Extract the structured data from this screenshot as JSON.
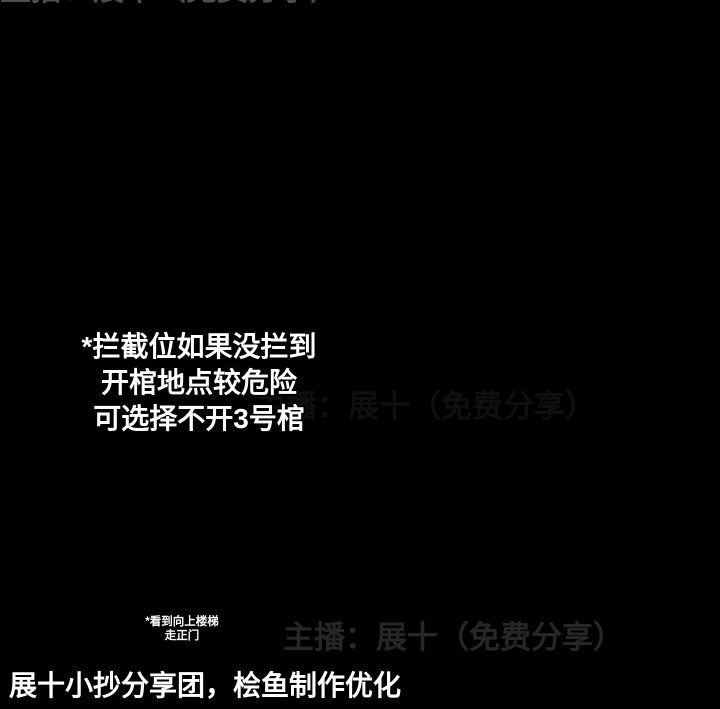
{
  "title": {
    "line1": "双队打架图",
    "line2": "3号位"
  },
  "note": [
    "*拦截位如果没拦到",
    "开棺地点较危险",
    "可选择不开3号棺"
  ],
  "small_note": [
    "*看到向上楼梯",
    "走正门"
  ],
  "watermark_text": "主播：展十（免费分享）",
  "footer": "展十小抄分享团，桧鱼制作优化",
  "icons": {
    "coffin": "chinese-coffin",
    "ladder": "ladder",
    "door_marker": "teal-dash",
    "spawn_marker": "red-diamond"
  },
  "palette": {
    "bg": "#000000",
    "B": "#4d6174",
    "B2": "#42566a",
    "N": "#2e3d4c",
    "R": "#8b5d55",
    "R2": "#74473f",
    "D": "#5d423c",
    "M": "#6b403c",
    "T": "#24424c",
    "magenta": "#f411af",
    "red": "#e60f1b",
    "cyan": "#22dcf2",
    "green": "#27e23c",
    "lime": "#19e839",
    "yellow": "#eeea28",
    "title_cyan": "#8df0f6",
    "white": "#ffffff",
    "watermark": "#9a9a9a"
  },
  "labels": [
    {
      "t": "正1",
      "x": 184,
      "y": 77,
      "fs": 29,
      "c": "white",
      "a": "start",
      "outline": true
    },
    {
      "t": "侧1",
      "x": 377,
      "y": 167,
      "fs": 26,
      "c": "green",
      "a": "start",
      "outline": true
    },
    {
      "t": "侧2",
      "x": 142,
      "y": 611,
      "fs": 29,
      "c": "green",
      "a": "start",
      "outline": true
    },
    {
      "t": "正2",
      "x": 339,
      "y": 610,
      "fs": 29,
      "c": "white",
      "a": "start",
      "outline": true
    },
    {
      "t": "1",
      "x": 544,
      "y": 553,
      "fs": 36,
      "c": "magenta",
      "a": "middle",
      "outline": true
    },
    {
      "t": "2",
      "x": 624,
      "y": 414,
      "fs": 34,
      "c": "cyan",
      "a": "middle",
      "outline": true
    },
    {
      "t": "3",
      "x": 517,
      "y": 503,
      "fs": 32,
      "c": "red",
      "a": "middle",
      "outline": true
    }
  ],
  "watermarks": [
    {
      "x": 48,
      "y": 153,
      "fs": 31,
      "op": 0.5
    },
    {
      "x": 283,
      "y": 648,
      "fs": 31,
      "op": 0.5
    },
    {
      "x": 255,
      "y": 417,
      "fs": 31,
      "op": 0.2
    }
  ],
  "map": {
    "rects": [
      {
        "x": 52,
        "y": 33,
        "w": 48,
        "h": 15,
        "c": "B"
      },
      {
        "x": 64,
        "y": 22,
        "w": 12,
        "h": 13,
        "c": "B"
      },
      {
        "x": 46,
        "y": 46,
        "w": 14,
        "h": 11,
        "c": "B"
      },
      {
        "x": 88,
        "y": 49,
        "w": 26,
        "h": 13,
        "c": "B"
      },
      {
        "x": 106,
        "y": 57,
        "w": 28,
        "h": 13,
        "c": "B"
      },
      {
        "x": 124,
        "y": 63,
        "w": 24,
        "h": 15,
        "c": "B"
      },
      {
        "x": 136,
        "y": 52,
        "w": 46,
        "h": 50,
        "c": "B2"
      },
      {
        "x": 143,
        "y": 60,
        "w": 32,
        "h": 30,
        "c": "N"
      },
      {
        "x": 80,
        "y": 86,
        "w": 58,
        "h": 52,
        "c": "R"
      },
      {
        "x": 137,
        "y": 86,
        "w": 9,
        "h": 52,
        "c": "B"
      },
      {
        "x": 143,
        "y": 83,
        "w": 58,
        "h": 17,
        "c": "B"
      },
      {
        "x": 197,
        "y": 100,
        "w": 18,
        "h": 80,
        "c": "B"
      },
      {
        "x": 148,
        "y": 177,
        "w": 98,
        "h": 16,
        "c": "B"
      },
      {
        "x": 168,
        "y": 162,
        "w": 13,
        "h": 15,
        "c": "B"
      },
      {
        "x": 238,
        "y": 166,
        "w": 13,
        "h": 11,
        "c": "B"
      },
      {
        "x": 163,
        "y": 193,
        "w": 16,
        "h": 48,
        "c": "B"
      },
      {
        "x": 150,
        "y": 239,
        "w": 47,
        "h": 14,
        "c": "B"
      },
      {
        "x": 168,
        "y": 253,
        "w": 15,
        "h": 16,
        "c": "B"
      },
      {
        "x": 213,
        "y": 180,
        "w": 30,
        "h": 12,
        "c": "B"
      },
      {
        "x": 242,
        "y": 168,
        "w": 40,
        "h": 13,
        "c": "B"
      },
      {
        "x": 278,
        "y": 160,
        "w": 60,
        "h": 17,
        "c": "B"
      },
      {
        "x": 337,
        "y": 162,
        "w": 24,
        "h": 31,
        "c": "B"
      },
      {
        "x": 298,
        "y": 129,
        "w": 30,
        "h": 26,
        "c": "B"
      },
      {
        "x": 347,
        "y": 152,
        "w": 24,
        "h": 38,
        "c": "B"
      },
      {
        "x": 358,
        "y": 108,
        "w": 25,
        "h": 26,
        "c": "B"
      },
      {
        "x": 378,
        "y": 112,
        "w": 20,
        "h": 31,
        "c": "M"
      },
      {
        "x": 360,
        "y": 133,
        "w": 19,
        "h": 19,
        "c": "B"
      },
      {
        "x": 282,
        "y": 174,
        "w": 18,
        "h": 16,
        "c": "N"
      },
      {
        "x": 348,
        "y": 181,
        "w": 56,
        "h": 51,
        "c": "R"
      },
      {
        "x": 253,
        "y": 198,
        "w": 62,
        "h": 30,
        "c": "R"
      },
      {
        "x": 292,
        "y": 238,
        "w": 41,
        "h": 42,
        "c": "R"
      },
      {
        "x": 250,
        "y": 277,
        "w": 340,
        "h": 18,
        "c": "B"
      },
      {
        "x": 352,
        "y": 258,
        "w": 14,
        "h": 19,
        "c": "B"
      },
      {
        "x": 340,
        "y": 295,
        "w": 14,
        "h": 13,
        "c": "B"
      },
      {
        "x": 420,
        "y": 295,
        "w": 21,
        "h": 48,
        "c": "B"
      },
      {
        "x": 392,
        "y": 352,
        "w": 26,
        "h": 30,
        "c": "B2"
      },
      {
        "x": 397,
        "y": 357,
        "w": 14,
        "h": 14,
        "c": "N"
      },
      {
        "x": 445,
        "y": 248,
        "w": 30,
        "h": 49,
        "c": "R"
      },
      {
        "x": 497,
        "y": 249,
        "w": 24,
        "h": 46,
        "c": "B"
      },
      {
        "x": 500,
        "y": 295,
        "w": 22,
        "h": 56,
        "c": "B"
      },
      {
        "x": 503,
        "y": 326,
        "w": 26,
        "h": 25,
        "c": "N"
      },
      {
        "x": 460,
        "y": 315,
        "w": 23,
        "h": 22,
        "c": "B2"
      },
      {
        "x": 548,
        "y": 250,
        "w": 14,
        "h": 28,
        "c": "B"
      },
      {
        "x": 548,
        "y": 295,
        "w": 15,
        "h": 15,
        "c": "B"
      },
      {
        "x": 485,
        "y": 208,
        "w": 30,
        "h": 62,
        "c": "R"
      },
      {
        "x": 487,
        "y": 245,
        "w": 20,
        "h": 20,
        "c": "N"
      },
      {
        "x": 686,
        "y": 158,
        "w": 28,
        "h": 21,
        "c": "B"
      },
      {
        "x": 690,
        "y": 179,
        "w": 30,
        "h": 133,
        "c": "R"
      },
      {
        "x": 648,
        "y": 297,
        "w": 28,
        "h": 59,
        "c": "R"
      },
      {
        "x": 630,
        "y": 325,
        "w": 19,
        "h": 31,
        "c": "R"
      },
      {
        "x": 590,
        "y": 328,
        "w": 32,
        "h": 21,
        "c": "B"
      },
      {
        "x": 548,
        "y": 317,
        "w": 55,
        "h": 33,
        "c": "B"
      },
      {
        "x": 470,
        "y": 297,
        "w": 31,
        "h": 33,
        "c": "B"
      },
      {
        "x": 500,
        "y": 313,
        "w": 34,
        "h": 18,
        "c": "B"
      },
      {
        "x": 420,
        "y": 399,
        "w": 22,
        "h": 18,
        "c": "B"
      },
      {
        "x": 477,
        "y": 399,
        "w": 103,
        "h": 18,
        "c": "B"
      },
      {
        "x": 428,
        "y": 345,
        "w": 48,
        "h": 82,
        "c": "R"
      },
      {
        "x": 436,
        "y": 398,
        "w": 20,
        "h": 16,
        "c": "D"
      },
      {
        "x": 441,
        "y": 400,
        "w": 16,
        "h": 16,
        "c": "N"
      },
      {
        "x": 509,
        "y": 394,
        "w": 26,
        "h": 22,
        "c": "N"
      },
      {
        "x": 500,
        "y": 417,
        "w": 41,
        "h": 63,
        "c": "R"
      },
      {
        "x": 504,
        "y": 425,
        "w": 20,
        "h": 18,
        "c": "D"
      },
      {
        "x": 568,
        "y": 430,
        "w": 62,
        "h": 47,
        "c": "R"
      },
      {
        "x": 580,
        "y": 441,
        "w": 26,
        "h": 24,
        "c": "D"
      },
      {
        "x": 567,
        "y": 487,
        "w": 63,
        "h": 58,
        "c": "R"
      },
      {
        "x": 580,
        "y": 501,
        "w": 28,
        "h": 26,
        "c": "D"
      },
      {
        "x": 598,
        "y": 540,
        "w": 24,
        "h": 9,
        "c": "R2"
      },
      {
        "x": 338,
        "y": 447,
        "w": 100,
        "h": 17,
        "c": "B"
      },
      {
        "x": 355,
        "y": 438,
        "w": 15,
        "h": 10,
        "c": "B"
      },
      {
        "x": 352,
        "y": 464,
        "w": 15,
        "h": 12,
        "c": "B"
      },
      {
        "x": 408,
        "y": 464,
        "w": 15,
        "h": 12,
        "c": "B"
      },
      {
        "x": 258,
        "y": 499,
        "w": 45,
        "h": 31,
        "c": "B"
      },
      {
        "x": 268,
        "y": 491,
        "w": 15,
        "h": 9,
        "c": "B"
      },
      {
        "x": 268,
        "y": 530,
        "w": 15,
        "h": 11,
        "c": "B"
      },
      {
        "x": 250,
        "y": 507,
        "w": 9,
        "h": 15,
        "c": "B"
      },
      {
        "x": 415,
        "y": 430,
        "w": 32,
        "h": 37,
        "c": "B"
      },
      {
        "x": 360,
        "y": 464,
        "w": 87,
        "h": 21,
        "c": "B"
      },
      {
        "x": 360,
        "y": 485,
        "w": 30,
        "h": 37,
        "c": "B"
      },
      {
        "x": 300,
        "y": 496,
        "w": 90,
        "h": 26,
        "c": "B"
      },
      {
        "x": 305,
        "y": 522,
        "w": 28,
        "h": 52,
        "c": "B"
      },
      {
        "x": 335,
        "y": 524,
        "w": 18,
        "h": 9,
        "c": "B"
      },
      {
        "x": 283,
        "y": 571,
        "w": 63,
        "h": 43,
        "c": "B"
      },
      {
        "x": 262,
        "y": 582,
        "w": 22,
        "h": 15,
        "c": "B"
      },
      {
        "x": 345,
        "y": 589,
        "w": 15,
        "h": 13,
        "c": "B"
      },
      {
        "x": 300,
        "y": 614,
        "w": 25,
        "h": 17,
        "c": "B"
      },
      {
        "x": 277,
        "y": 615,
        "w": 26,
        "h": 24,
        "c": "B"
      },
      {
        "x": 280,
        "y": 640,
        "w": 18,
        "h": 20,
        "c": "B"
      },
      {
        "x": 355,
        "y": 559,
        "w": 18,
        "h": 15,
        "c": "B"
      },
      {
        "x": 310,
        "y": 578,
        "w": 34,
        "h": 31,
        "c": "T"
      },
      {
        "x": 140,
        "y": 528,
        "w": 20,
        "h": 25,
        "c": "B"
      },
      {
        "x": 170,
        "y": 528,
        "w": 23,
        "h": 25,
        "c": "B"
      },
      {
        "x": 140,
        "y": 539,
        "w": 53,
        "h": 13,
        "c": "B"
      },
      {
        "x": 207,
        "y": 533,
        "w": 17,
        "h": 45,
        "c": "B"
      },
      {
        "x": 224,
        "y": 545,
        "w": 10,
        "h": 11,
        "c": "B"
      },
      {
        "x": 200,
        "y": 566,
        "w": 28,
        "h": 13,
        "c": "B"
      },
      {
        "x": 112,
        "y": 566,
        "w": 51,
        "h": 27,
        "c": "B"
      },
      {
        "x": 118,
        "y": 559,
        "w": 13,
        "h": 9,
        "c": "B"
      },
      {
        "x": 118,
        "y": 593,
        "w": 14,
        "h": 11,
        "c": "B"
      },
      {
        "x": 147,
        "y": 593,
        "w": 13,
        "h": 9,
        "c": "B"
      },
      {
        "x": 97,
        "y": 573,
        "w": 16,
        "h": 13,
        "c": "B"
      }
    ],
    "routes": [
      {
        "type": "poly",
        "color": "magenta",
        "w": 7,
        "pts": [
          [
            506,
            340
          ],
          [
            433,
            340
          ],
          [
            433,
            484
          ],
          [
            375,
            484
          ],
          [
            375,
            512
          ],
          [
            318,
            512
          ],
          [
            318,
            568
          ],
          [
            327,
            568
          ],
          [
            327,
            586
          ],
          [
            319,
            586
          ],
          [
            319,
            599
          ]
        ]
      },
      {
        "type": "loop",
        "color": "magenta",
        "w": 4,
        "x": 503,
        "y": 324,
        "wd": 29,
        "ht": 29
      },
      {
        "type": "poly",
        "color": "magenta",
        "w": 2.5,
        "pts": [
          [
            517,
            353
          ],
          [
            517,
            392
          ]
        ]
      },
      {
        "type": "loop",
        "color": "magenta",
        "w": 4,
        "x": 507,
        "y": 392,
        "wd": 31,
        "ht": 27
      },
      {
        "type": "poly",
        "color": "magenta",
        "w": 7,
        "pts": [
          [
            537,
            407
          ],
          [
            579,
            407
          ],
          [
            579,
            525
          ]
        ]
      },
      {
        "type": "poly",
        "color": "red",
        "w": 7,
        "pts": [
          [
            502,
            402
          ],
          [
            502,
            439
          ],
          [
            524,
            439
          ],
          [
            524,
            455
          ]
        ]
      },
      {
        "type": "poly",
        "color": "cyan",
        "w": 2.5,
        "pts": [
          [
            617,
            466
          ],
          [
            617,
            499
          ]
        ]
      },
      {
        "type": "poly",
        "color": "cyan",
        "w": 6,
        "pts": [
          [
            617,
            524
          ],
          [
            617,
            532
          ],
          [
            592,
            532
          ]
        ]
      },
      {
        "type": "ladder",
        "x": 611,
        "y": 441,
        "wd": 12,
        "ht": 25,
        "rungs": 4
      },
      {
        "type": "ladder",
        "x": 610,
        "y": 497,
        "wd": 13,
        "ht": 30,
        "rungs": 6
      }
    ],
    "coffins": [
      {
        "x": 160,
        "y": 73,
        "s": 40,
        "r": -20,
        "v": "dim"
      },
      {
        "x": 372,
        "y": 191,
        "s": 44,
        "r": 0,
        "v": "std"
      },
      {
        "x": 287,
        "y": 222,
        "s": 42,
        "r": 0,
        "v": "std"
      },
      {
        "x": 309,
        "y": 254,
        "s": 44,
        "r": 0,
        "v": "std"
      },
      {
        "x": 500,
        "y": 196,
        "s": 40,
        "r": 0,
        "v": "std"
      },
      {
        "x": 706,
        "y": 199,
        "s": 38,
        "r": 0,
        "v": "std"
      },
      {
        "x": 431,
        "y": 287,
        "s": 40,
        "r": 0,
        "v": "std"
      },
      {
        "x": 459,
        "y": 376,
        "s": 46,
        "r": 0,
        "v": "std"
      },
      {
        "x": 519,
        "y": 467,
        "s": 46,
        "r": 0,
        "v": "std"
      },
      {
        "x": 634,
        "y": 344,
        "s": 42,
        "r": 0,
        "v": "std"
      },
      {
        "x": 622,
        "y": 429,
        "s": 46,
        "r": 0,
        "v": "std"
      },
      {
        "x": 577,
        "y": 541,
        "s": 46,
        "r": 0,
        "v": "gold"
      },
      {
        "x": 326,
        "y": 594,
        "s": 36,
        "r": -10,
        "v": "dark"
      }
    ],
    "diamonds": [
      [
        181,
        128
      ],
      [
        264,
        122
      ],
      [
        313,
        147
      ],
      [
        440,
        351
      ],
      [
        530,
        408
      ],
      [
        375,
        456
      ],
      [
        287,
        513
      ],
      [
        203,
        540
      ],
      [
        286,
        538
      ]
    ],
    "doors": [
      [
        270,
        164
      ],
      [
        313,
        162
      ],
      [
        492,
        238
      ],
      [
        341,
        528
      ],
      [
        232,
        612
      ],
      [
        445,
        254
      ],
      [
        690,
        310
      ]
    ],
    "green_markers": [
      {
        "x": 352,
        "y": 146,
        "w": 22,
        "h": 7
      },
      {
        "x": 163,
        "y": 569,
        "w": 9,
        "h": 22
      }
    ],
    "gold_outline": "M556,527 L571,516 L598,521 L606,541 L596,560 L568,565 L551,549 Z"
  }
}
